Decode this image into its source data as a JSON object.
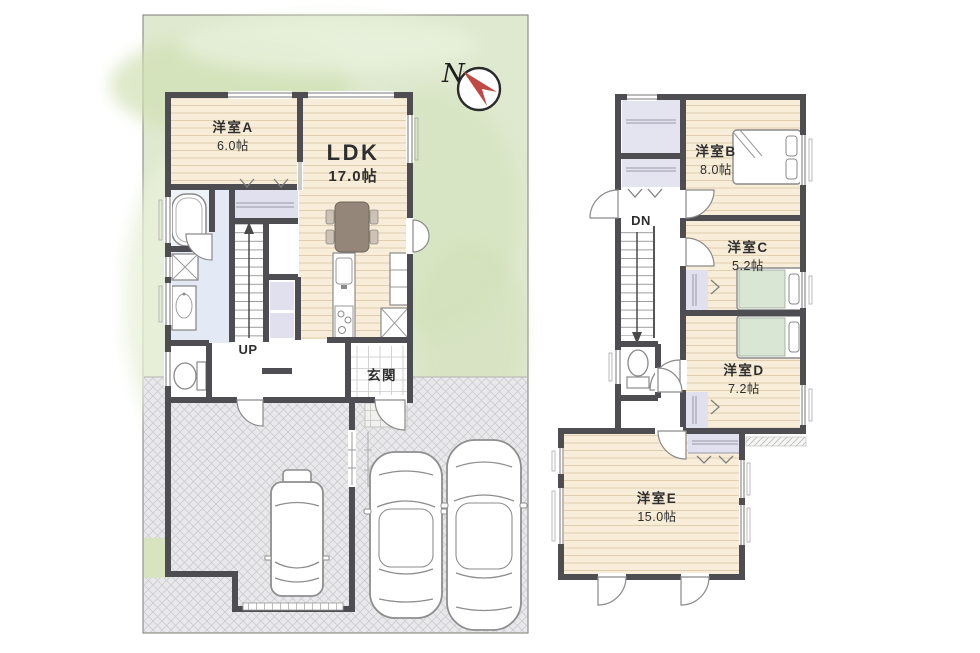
{
  "compass": {
    "label": "N"
  },
  "floor1": {
    "room_a": {
      "name": "洋室A",
      "size": "6.0帖"
    },
    "ldk": {
      "name": "LDK",
      "size": "17.0帖"
    },
    "entrance": {
      "name": "玄関"
    },
    "stairs": {
      "label": "UP"
    }
  },
  "floor2": {
    "room_b": {
      "name": "洋室B",
      "size": "8.0帖"
    },
    "room_c": {
      "name": "洋室C",
      "size": "5.2帖"
    },
    "room_d": {
      "name": "洋室D",
      "size": "7.2帖"
    },
    "room_e": {
      "name": "洋室E",
      "size": "15.0帖"
    },
    "stairs": {
      "label": "DN"
    }
  },
  "colors": {
    "wall": "#4d4d52",
    "garden": "#dfe9cf",
    "parking": "#e9e9eb",
    "wood": "#f8edd8",
    "closet": "#e0e0ee",
    "bath": "#e4eaf5",
    "compass_red": "#bf4a45"
  }
}
